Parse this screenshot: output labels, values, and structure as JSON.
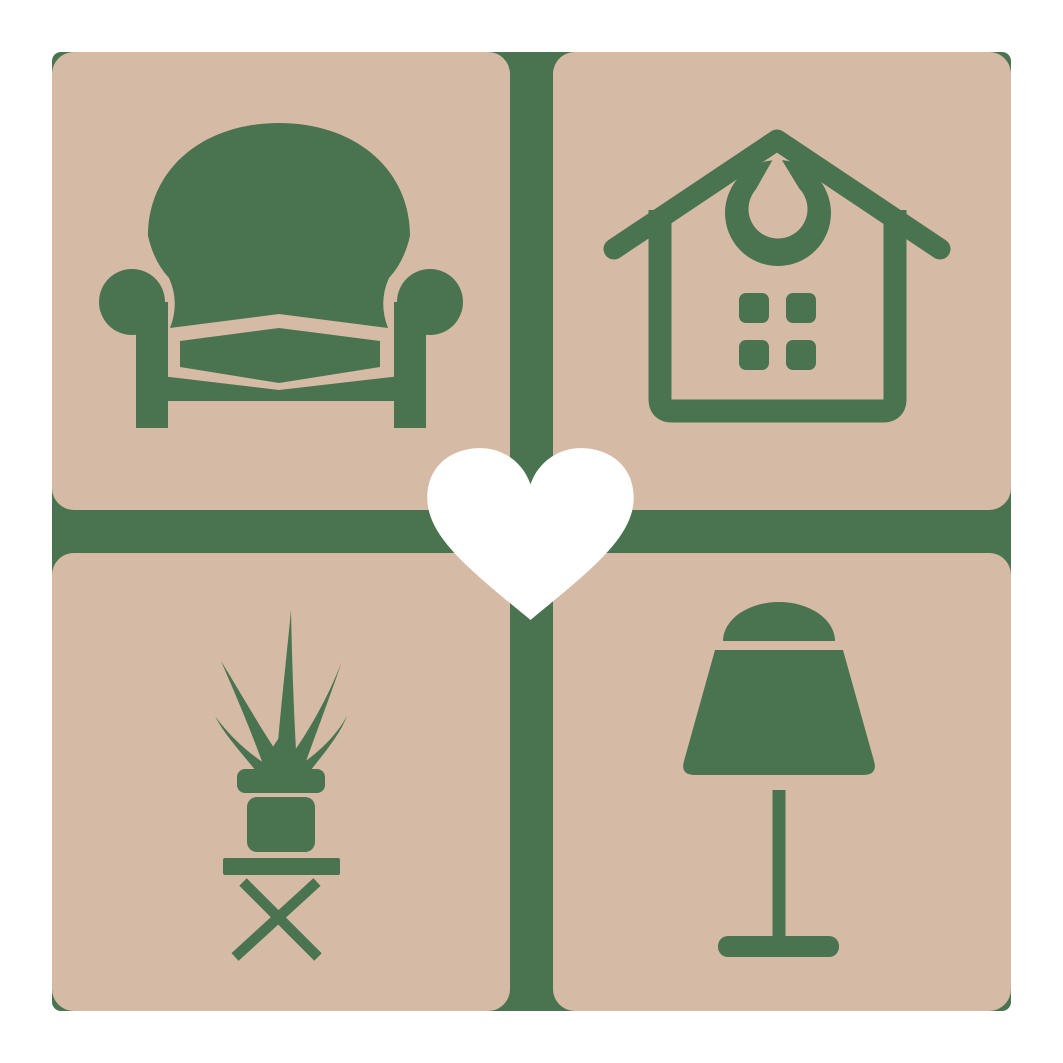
{
  "logo": {
    "name": "home-decor-logo",
    "description": "Square logo: four tan rounded tiles on a green backing cross, furniture icons in each tile, white heart at center",
    "colors": {
      "background": "#ffffff",
      "tile": "#d5bba6",
      "icon": "#4a744f",
      "heart": "#ffffff"
    },
    "tiles": [
      {
        "position": "top-left",
        "icon": "armchair-icon",
        "label": "armchair"
      },
      {
        "position": "top-right",
        "icon": "house-icon",
        "label": "house with windows"
      },
      {
        "position": "bottom-left",
        "icon": "potted-plant-icon",
        "label": "potted plant on folding stool"
      },
      {
        "position": "bottom-right",
        "icon": "table-lamp-icon",
        "label": "table lamp"
      }
    ],
    "center": {
      "icon": "heart-icon",
      "label": "heart"
    }
  }
}
